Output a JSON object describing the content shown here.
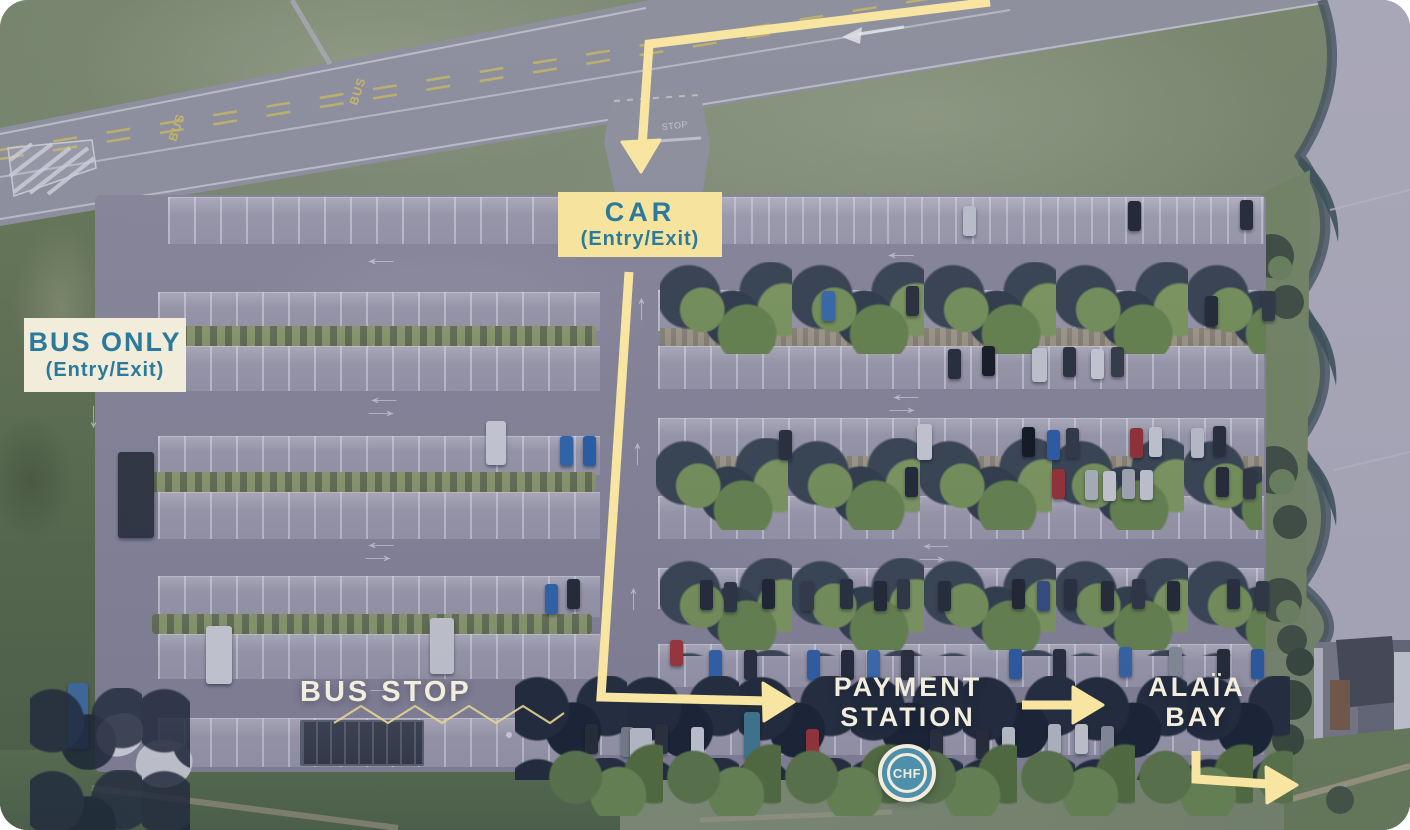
{
  "annotations": {
    "car_entry": {
      "title": "CAR",
      "subtitle": "(Entry/Exit)"
    },
    "bus_entry": {
      "title": "BUS ONLY",
      "subtitle": "(Entry/Exit)"
    },
    "bus_stop_label": "BUS STOP",
    "payment_station": {
      "line1": "PAYMENT",
      "line2": "STATION"
    },
    "alaia_bay": {
      "line1": "ALAÏA",
      "line2": "BAY"
    },
    "currency_badge": "CHF"
  },
  "road_markings": {
    "bus_lane": "BUS",
    "stop": "STOP"
  },
  "colors": {
    "route_yellow": "#F7E5A1",
    "label_box_yellow": "#F6E49E",
    "label_box_cream": "#F2EDDA",
    "label_text_teal": "#2B7A9B",
    "overlay_text_cream": "#F2EDDC",
    "badge_blue": "#4E90AB"
  }
}
